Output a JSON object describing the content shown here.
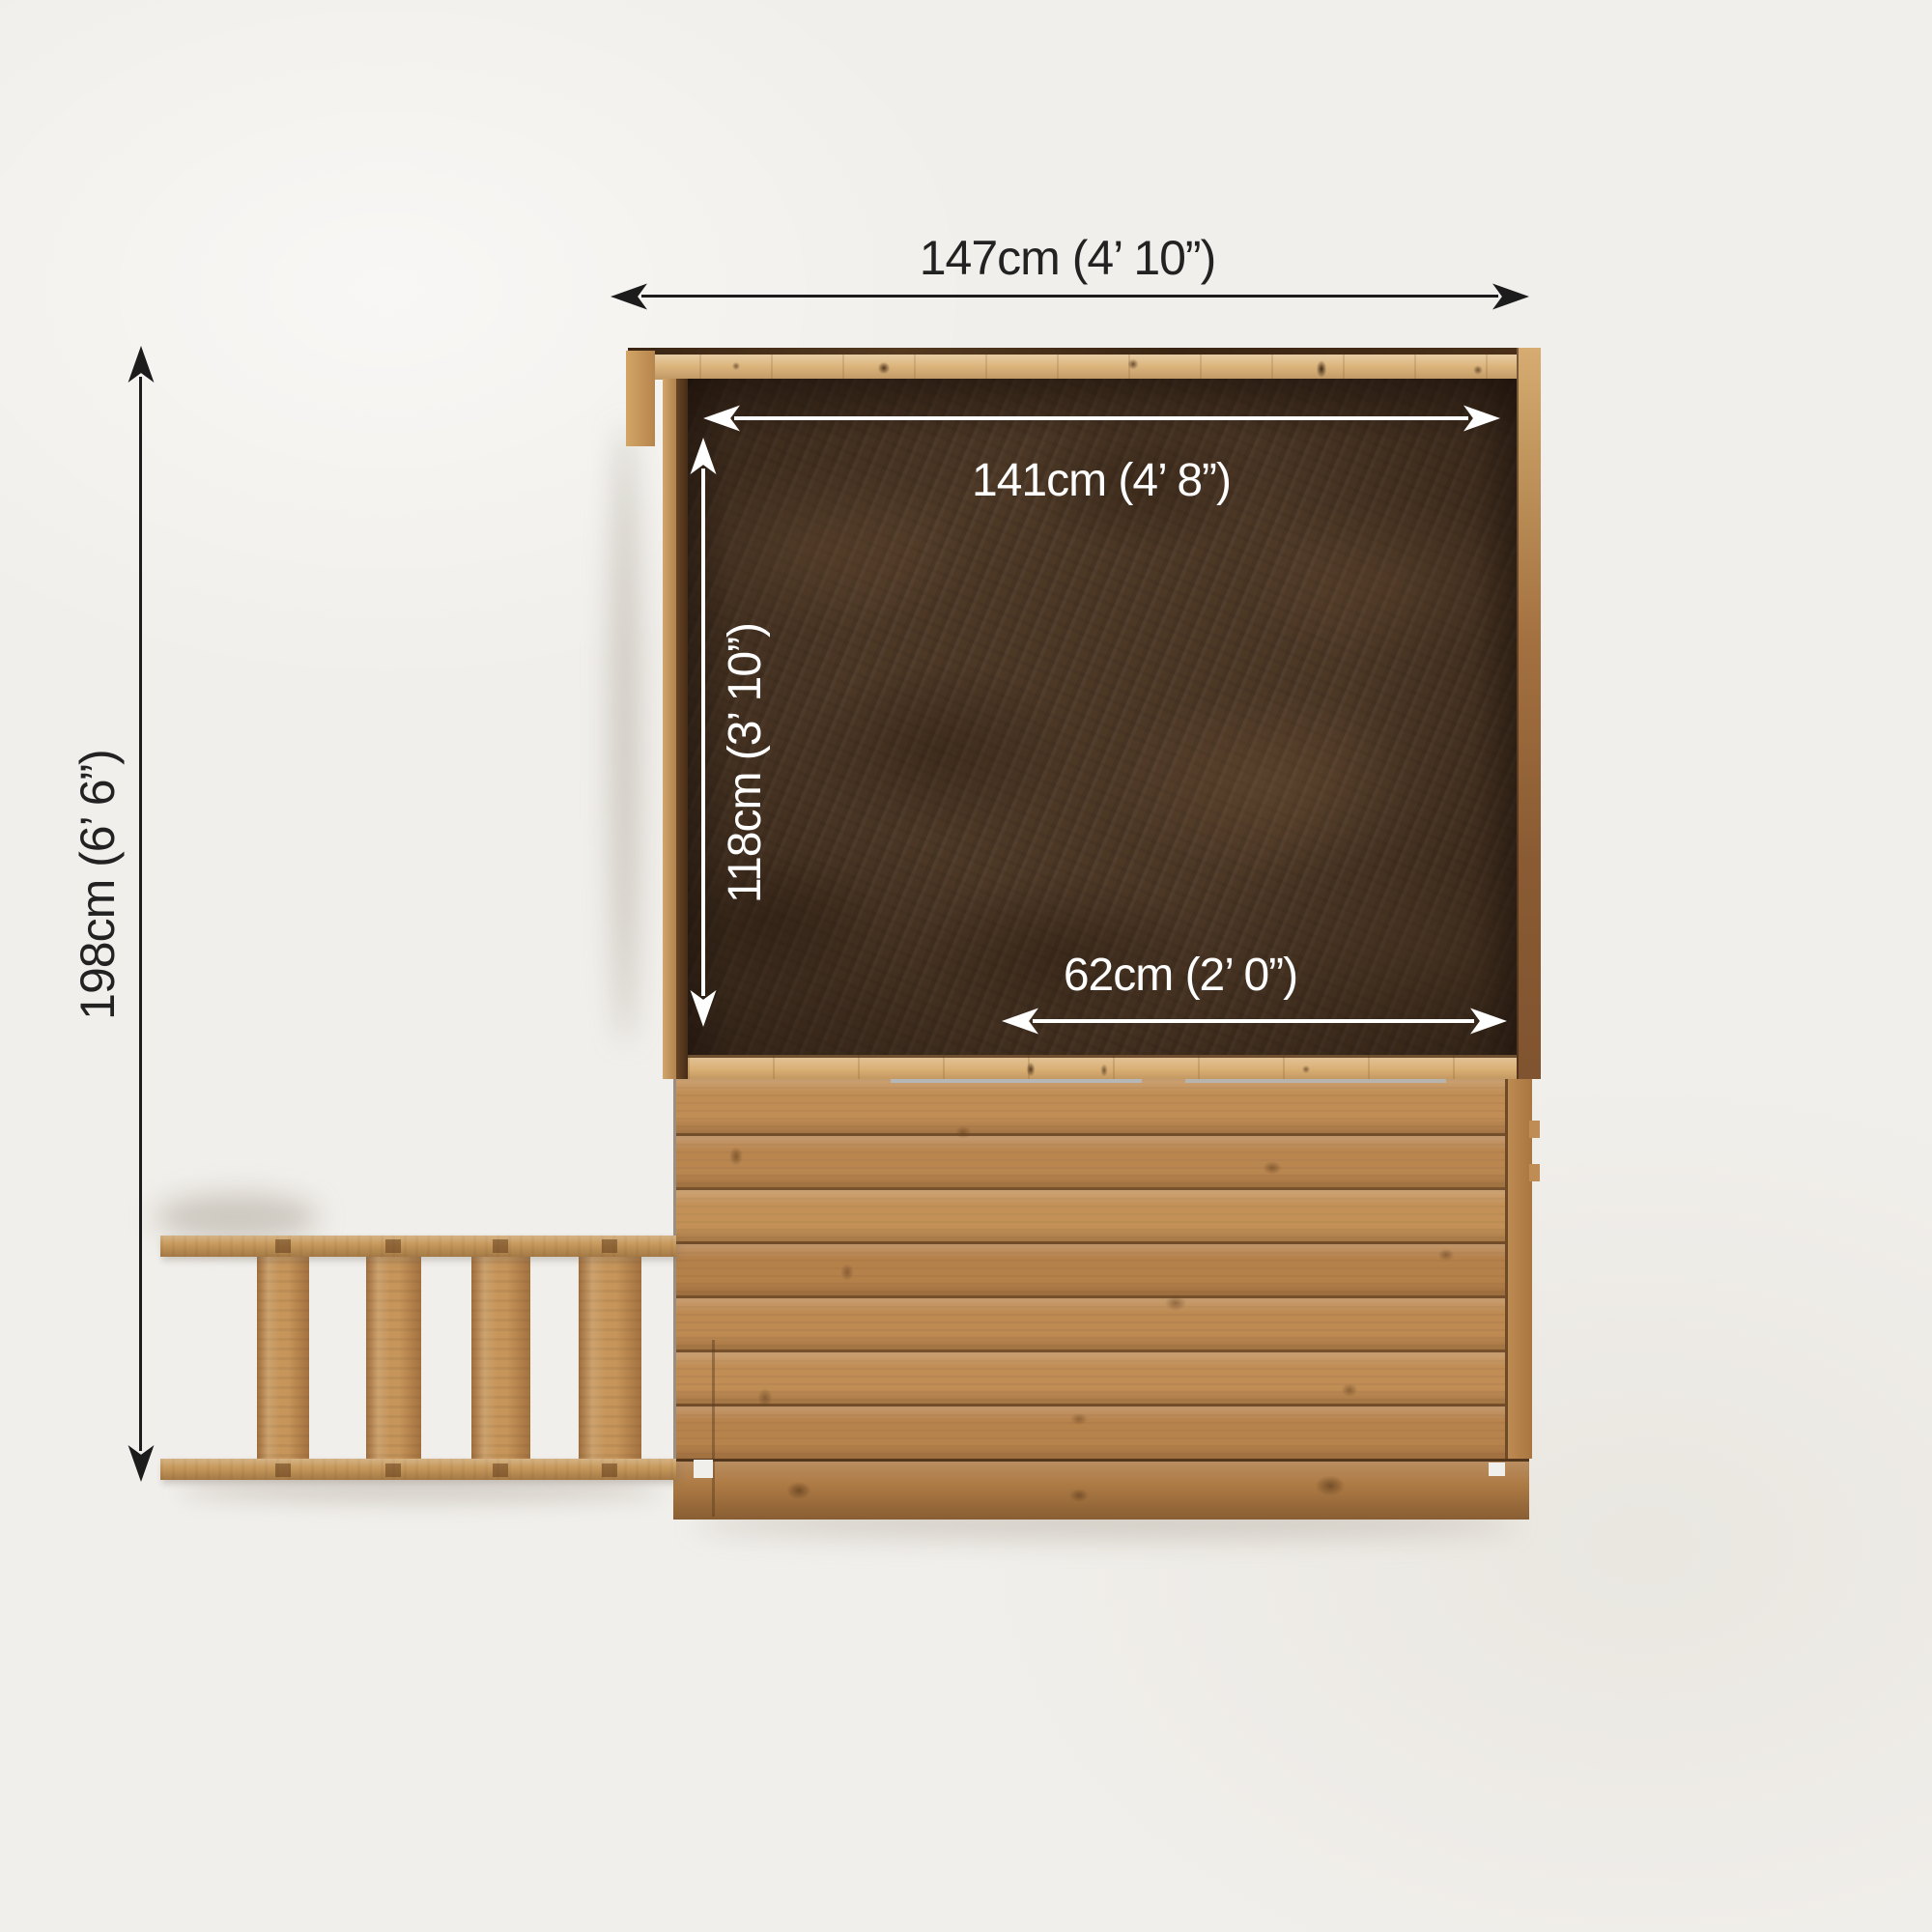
{
  "dimensions": {
    "overall_width": {
      "label": "147cm (4’ 10”)",
      "cm": 147,
      "ft_in": "4’ 10”"
    },
    "inner_width": {
      "label": "141cm (4’ 8”)",
      "cm": 141,
      "ft_in": "4’ 8”"
    },
    "inner_depth": {
      "label": "118cm (3’ 10”)",
      "cm": 118,
      "ft_in": "3’ 10”"
    },
    "opening_width": {
      "label": "62cm (2’ 0”)",
      "cm": 62,
      "ft_in": "2’ 0”"
    },
    "overall_depth": {
      "label": "198cm (6’ 6”)",
      "cm": 198,
      "ft_in": "6’ 6”"
    }
  },
  "colors": {
    "background": "#f1efeb",
    "arrow_dark": "#1c1c1c",
    "arrow_light": "#ffffff",
    "osb_panel": "#4d3826",
    "frame_wood": "#ddb67e",
    "deck_wood": "#bd8a52",
    "ladder_wood": "#c6955a"
  }
}
